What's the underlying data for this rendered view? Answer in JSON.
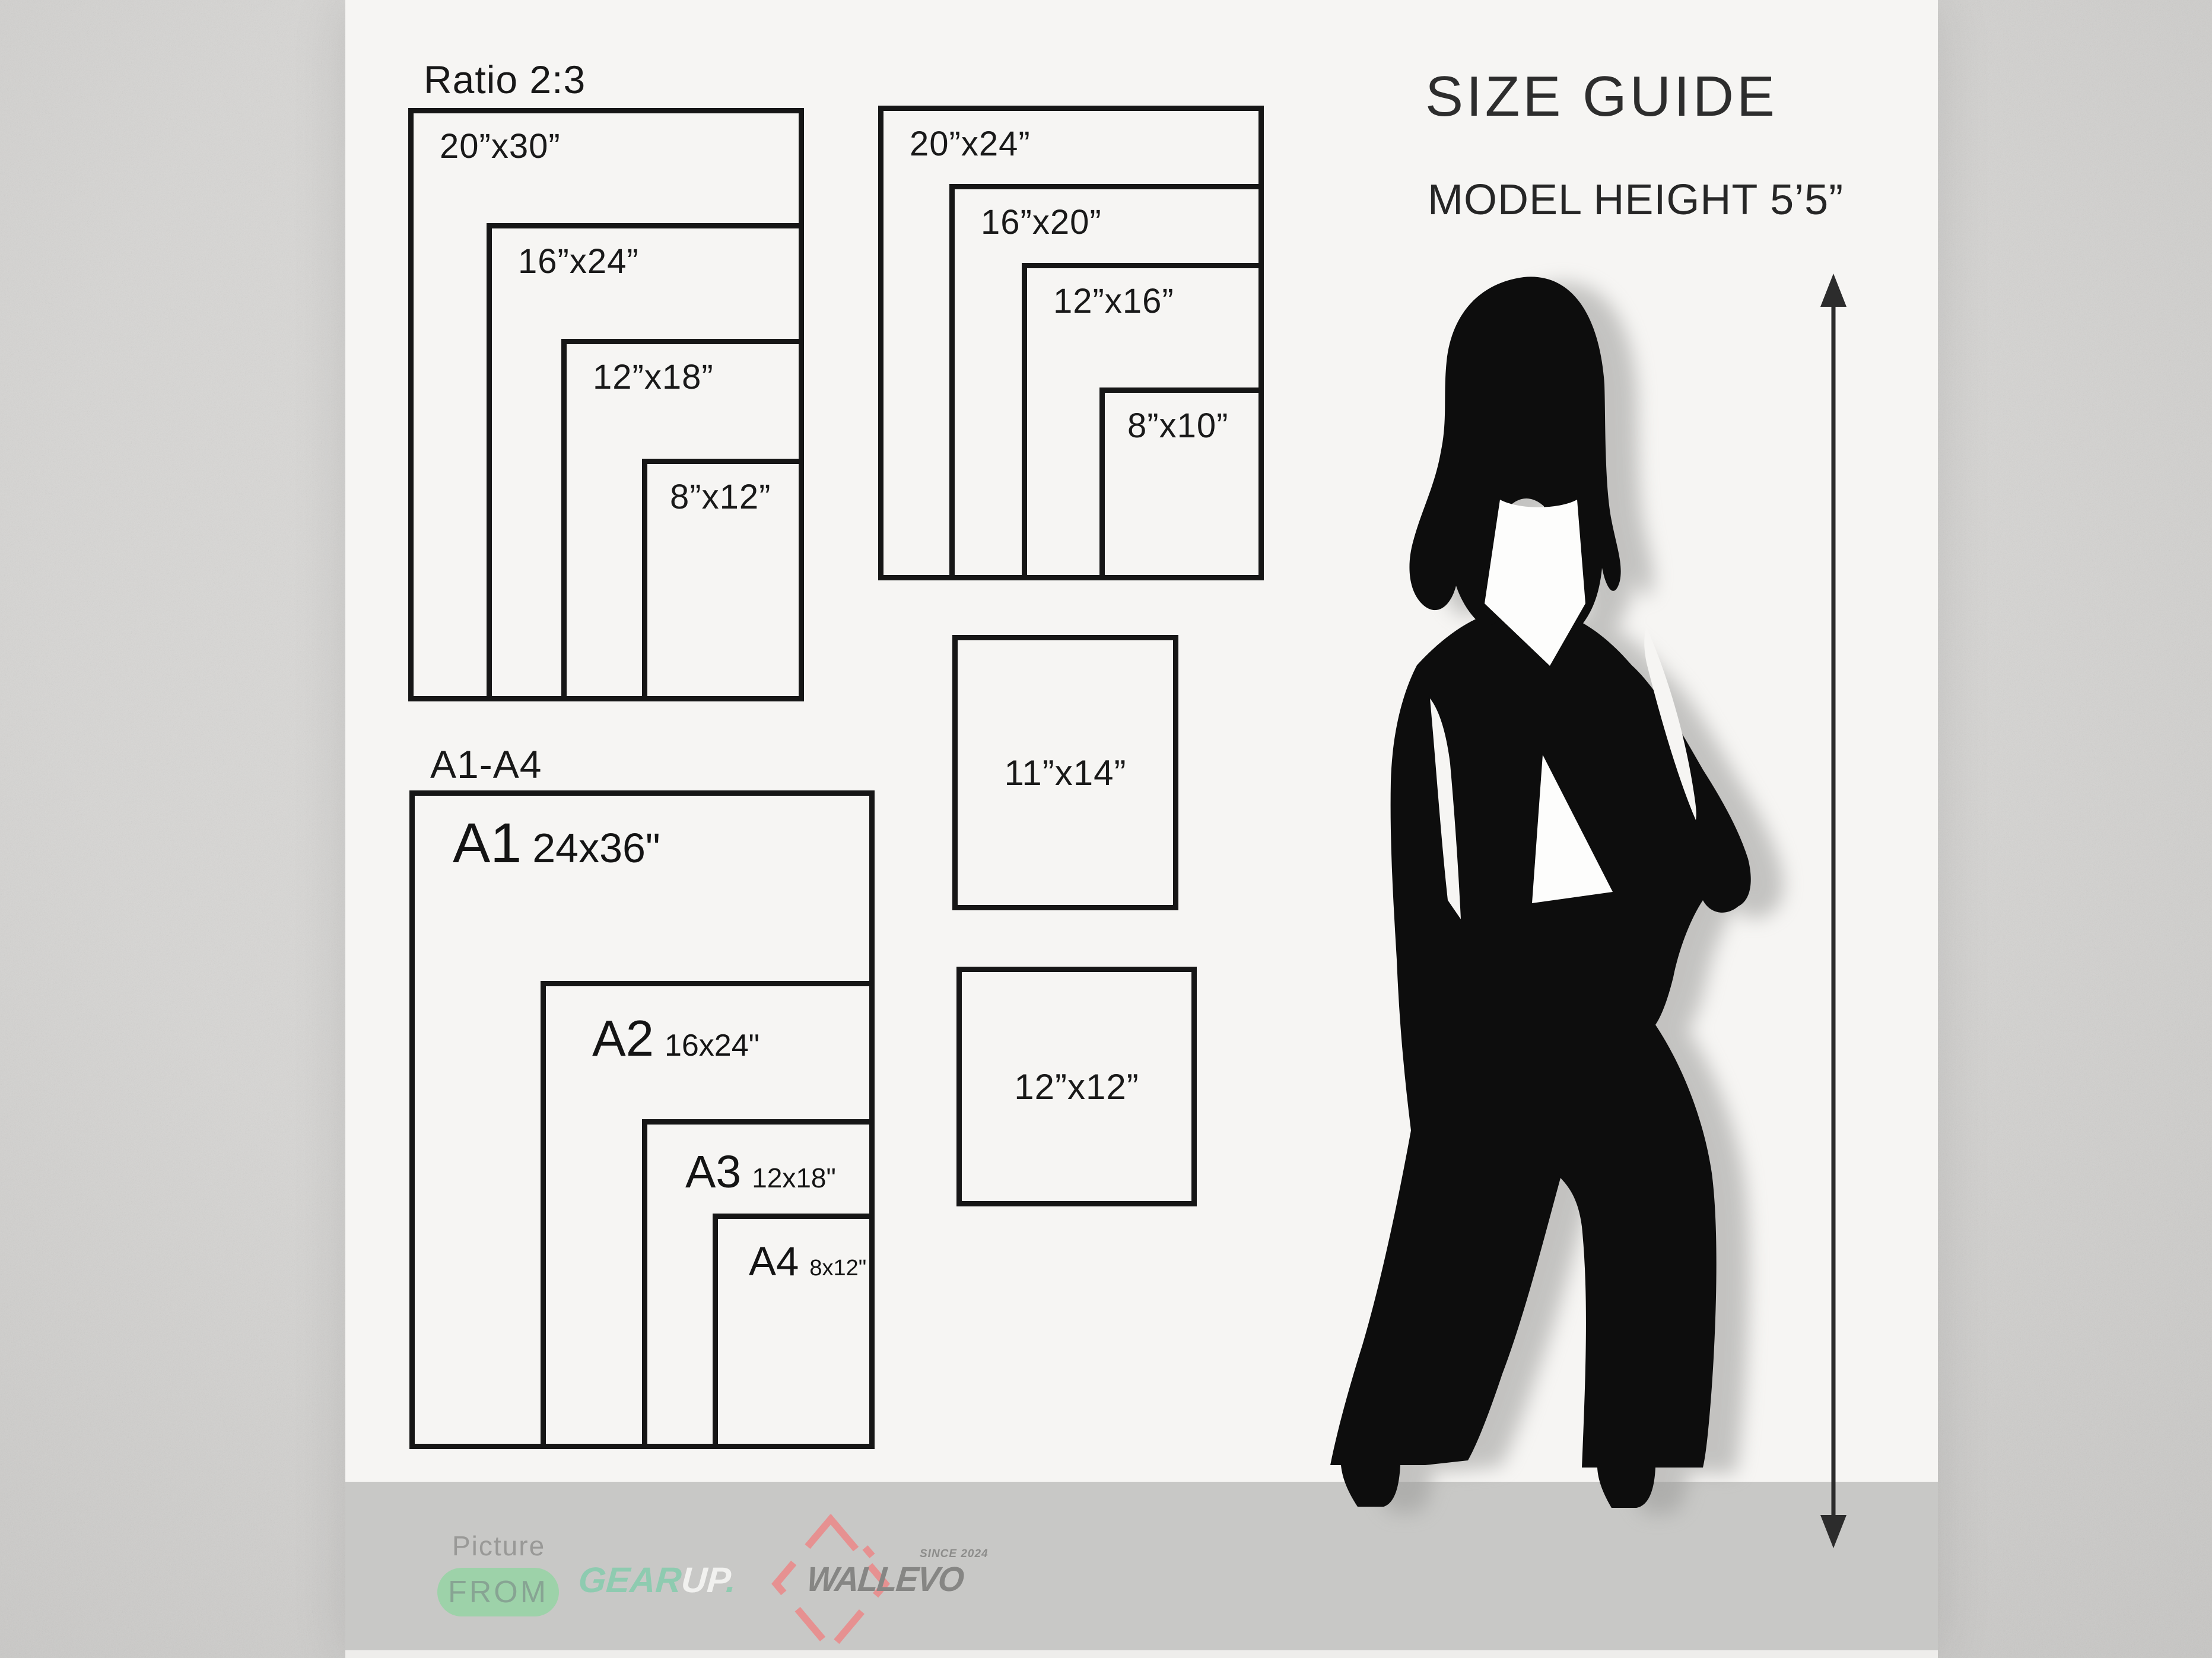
{
  "right_column": {
    "title": "SIZE GUIDE",
    "model_height": "MODEL HEIGHT 5’5”"
  },
  "ratio_group": {
    "heading": "Ratio 2:3",
    "sizes": [
      "20”x30”",
      "16”x24”",
      "12”x18”",
      "8”x12”"
    ]
  },
  "standard_group": {
    "sizes": [
      "20”x24”",
      "16”x20”",
      "12”x16”",
      "8”x10”"
    ]
  },
  "single_frames": [
    "11”x14”",
    "12”x12”"
  ],
  "a_series": {
    "heading": "A1-A4",
    "items": [
      {
        "code": "A1",
        "size": "24x36\""
      },
      {
        "code": "A2",
        "size": "16x24\""
      },
      {
        "code": "A3",
        "size": "12x18\""
      },
      {
        "code": "A4",
        "size": "8x12\""
      }
    ]
  },
  "footer": {
    "picture_label": "Picture",
    "from_badge": "FROM",
    "gearup_part1": "GEAR",
    "gearup_part2": "UP",
    "gearup_dot": ".",
    "wallevo_name": "WALLEVO",
    "wallevo_since": "SINCE 2024"
  },
  "colors": {
    "panel": "#f6f5f3",
    "footer_bar": "#c8c8c6",
    "box_border": "#161616",
    "from_pill_green": "#9dd2a9",
    "gearup_teal": "#8ecbb0",
    "gearup_white": "#f1f1ef",
    "wallevo_gray": "#868684",
    "wallevo_pink": "#e69191",
    "silhouette_black": "#0d0d0d"
  }
}
